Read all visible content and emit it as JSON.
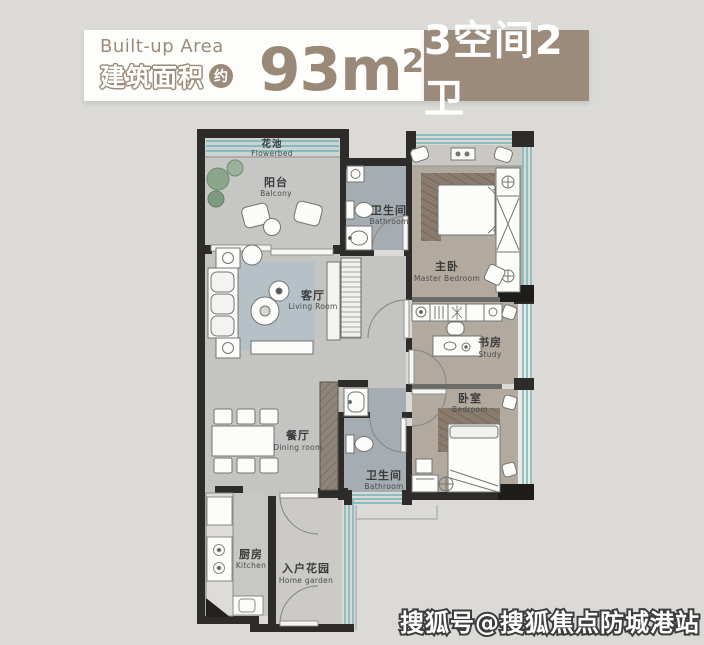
{
  "header": {
    "built_up_area_en": "Built-up Area",
    "built_up_area_cn": "建筑面积",
    "approx_label": "约",
    "area_number": "93",
    "area_unit": "m",
    "area_exponent": "2",
    "layout_badge": "3空间2卫"
  },
  "colors": {
    "accent": "#9c8b7a",
    "badge_text": "#ffffff",
    "window_teal": "#72b2b6",
    "wall_dark": "#2e2c2a"
  },
  "floor_plan": {
    "rooms": {
      "flowerbed": {
        "cn": "花池",
        "en": "Flowerbed"
      },
      "balcony": {
        "cn": "阳台",
        "en": "Balcony"
      },
      "living_room": {
        "cn": "客厅",
        "en": "Living Room"
      },
      "dining_room": {
        "cn": "餐厅",
        "en": "Dining room"
      },
      "kitchen": {
        "cn": "厨房",
        "en": "Kitchen"
      },
      "home_garden": {
        "cn": "入户花园",
        "en": "Home garden"
      },
      "bathroom_upper": {
        "cn": "卫生间",
        "en": "Bathroom"
      },
      "bathroom_lower": {
        "cn": "卫生间",
        "en": "Bathroom"
      },
      "master_bedroom": {
        "cn": "主卧",
        "en": "Master Bedroom"
      },
      "study": {
        "cn": "书房",
        "en": "Study"
      },
      "bedroom": {
        "cn": "卧室",
        "en": "Bedroom"
      }
    }
  },
  "watermark": {
    "text": "搜狐号@搜狐焦点防城港站"
  }
}
